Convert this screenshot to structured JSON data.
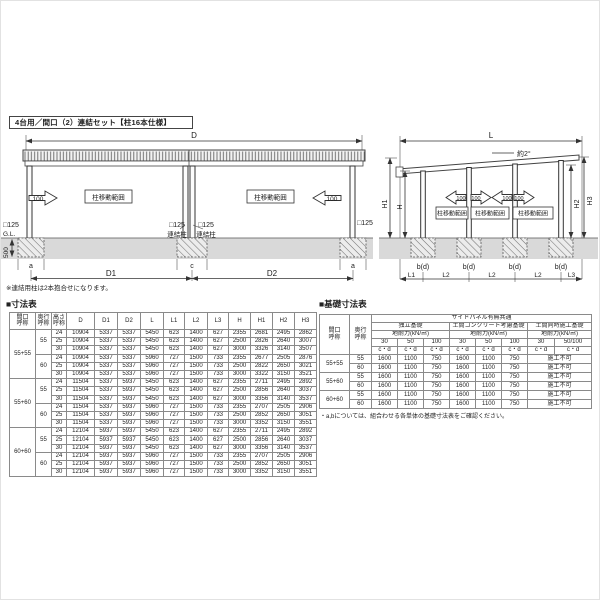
{
  "page": {
    "title": "4台用／間口（2）連結セット【柱16本仕様】"
  },
  "colors": {
    "ground": "#d9d9d9",
    "line": "#333333"
  },
  "front_view": {
    "dim_d": "D",
    "dim_d1": "D1",
    "dim_d2": "D2",
    "dim_a": "a",
    "dim_c": "c",
    "dim_500": "500",
    "gl": "G.L.",
    "sq125": "□125",
    "renketsu_pillar": "連結柱",
    "range_label": "柱移動範囲",
    "move_100": "100",
    "note": "※連結用柱は2本抱合せになります。"
  },
  "side_view": {
    "dim_l": "L",
    "slope": "約2°",
    "dim_h": "H",
    "dim_h1": "H1",
    "dim_h2": "H2",
    "dim_h3": "H3",
    "dim_l1": "L1",
    "dim_l2": "L2",
    "dim_l3": "L3",
    "bd": "b(d)",
    "range_label": "柱移動範囲",
    "move_100": "100"
  },
  "dim_table": {
    "title": "■寸法表",
    "headers": [
      "間口\n呼称",
      "奥行\n呼称",
      "高さ\n呼称",
      "D",
      "D1",
      "D2",
      "L",
      "L1",
      "L2",
      "L3",
      "H",
      "H1",
      "H2",
      "H3"
    ],
    "groups": [
      {
        "span": "55+55",
        "depths": [
          {
            "depth": "55",
            "rows": [
              [
                "24",
                "10904",
                "5337",
                "5337",
                "5450",
                "623",
                "1400",
                "627",
                "2355",
                "2681",
                "2495",
                "2862"
              ],
              [
                "25",
                "10904",
                "5337",
                "5337",
                "5450",
                "623",
                "1400",
                "627",
                "2500",
                "2826",
                "2640",
                "3007"
              ],
              [
                "30",
                "10904",
                "5337",
                "5337",
                "5450",
                "623",
                "1400",
                "627",
                "3000",
                "3326",
                "3140",
                "3507"
              ]
            ]
          },
          {
            "depth": "60",
            "rows": [
              [
                "24",
                "10904",
                "5337",
                "5337",
                "5960",
                "727",
                "1500",
                "733",
                "2355",
                "2677",
                "2505",
                "2876"
              ],
              [
                "25",
                "10904",
                "5337",
                "5337",
                "5960",
                "727",
                "1500",
                "733",
                "2500",
                "2822",
                "2650",
                "3021"
              ],
              [
                "30",
                "10904",
                "5337",
                "5337",
                "5960",
                "727",
                "1500",
                "733",
                "3000",
                "3322",
                "3150",
                "3521"
              ]
            ]
          }
        ]
      },
      {
        "span": "55+60",
        "depths": [
          {
            "depth": "55",
            "rows": [
              [
                "24",
                "11504",
                "5337",
                "5937",
                "5450",
                "623",
                "1400",
                "627",
                "2355",
                "2711",
                "2495",
                "2892"
              ],
              [
                "25",
                "11504",
                "5337",
                "5937",
                "5450",
                "623",
                "1400",
                "627",
                "2500",
                "2856",
                "2640",
                "3037"
              ],
              [
                "30",
                "11504",
                "5337",
                "5937",
                "5450",
                "623",
                "1400",
                "627",
                "3000",
                "3356",
                "3140",
                "3537"
              ]
            ]
          },
          {
            "depth": "60",
            "rows": [
              [
                "24",
                "11504",
                "5337",
                "5937",
                "5960",
                "727",
                "1500",
                "733",
                "2355",
                "2707",
                "2505",
                "2906"
              ],
              [
                "25",
                "11504",
                "5337",
                "5937",
                "5960",
                "727",
                "1500",
                "733",
                "2500",
                "2852",
                "2650",
                "3051"
              ],
              [
                "30",
                "11504",
                "5337",
                "5937",
                "5960",
                "727",
                "1500",
                "733",
                "3000",
                "3352",
                "3150",
                "3551"
              ]
            ]
          }
        ]
      },
      {
        "span": "60+60",
        "depths": [
          {
            "depth": "55",
            "rows": [
              [
                "24",
                "12104",
                "5937",
                "5937",
                "5450",
                "623",
                "1400",
                "627",
                "2355",
                "2711",
                "2495",
                "2892"
              ],
              [
                "25",
                "12104",
                "5937",
                "5937",
                "5450",
                "623",
                "1400",
                "627",
                "2500",
                "2856",
                "2640",
                "3037"
              ],
              [
                "30",
                "12104",
                "5937",
                "5937",
                "5450",
                "623",
                "1400",
                "627",
                "3000",
                "3356",
                "3140",
                "3537"
              ]
            ]
          },
          {
            "depth": "60",
            "rows": [
              [
                "24",
                "12104",
                "5937",
                "5937",
                "5960",
                "727",
                "1500",
                "733",
                "2355",
                "2707",
                "2505",
                "2906"
              ],
              [
                "25",
                "12104",
                "5937",
                "5937",
                "5960",
                "727",
                "1500",
                "733",
                "2500",
                "2852",
                "2650",
                "3051"
              ],
              [
                "30",
                "12104",
                "5937",
                "5937",
                "5960",
                "727",
                "1500",
                "733",
                "3000",
                "3352",
                "3150",
                "3551"
              ]
            ]
          }
        ]
      }
    ]
  },
  "foundation_table": {
    "title": "■基礎寸法表",
    "top_header": "サイドパネル有無共通",
    "col1": "間口\n呼称",
    "col2": "奥行\n呼称",
    "groups": [
      {
        "name": "独立基礎",
        "sub": "地耐力(kN/㎡)"
      },
      {
        "name": "土間コンクリート考慮基礎",
        "sub": "地耐力(kN/㎡)"
      },
      {
        "name": "土間同時施工基礎",
        "sub": "地耐力(kN/㎡)"
      }
    ],
    "strengths": [
      "30",
      "50",
      "100",
      "30",
      "50",
      "100",
      "30",
      "50/100"
    ],
    "unit": "c・d",
    "rows": [
      {
        "span": "55+55",
        "depth": "55",
        "values": [
          "1600",
          "1100",
          "750",
          "1600",
          "1100",
          "750"
        ],
        "na": "施工不可"
      },
      {
        "span": "55+55",
        "depth": "60",
        "values": [
          "1600",
          "1100",
          "750",
          "1600",
          "1100",
          "750"
        ],
        "na": "施工不可"
      },
      {
        "span": "55+60",
        "depth": "55",
        "values": [
          "1600",
          "1100",
          "750",
          "1600",
          "1100",
          "750"
        ],
        "na": "施工不可"
      },
      {
        "span": "55+60",
        "depth": "60",
        "values": [
          "1600",
          "1100",
          "750",
          "1600",
          "1100",
          "750"
        ],
        "na": "施工不可"
      },
      {
        "span": "60+60",
        "depth": "55",
        "values": [
          "1600",
          "1100",
          "750",
          "1600",
          "1100",
          "750"
        ],
        "na": "施工不可"
      },
      {
        "span": "60+60",
        "depth": "60",
        "values": [
          "1600",
          "1100",
          "750",
          "1600",
          "1100",
          "750"
        ],
        "na": "施工不可"
      }
    ],
    "note": "・a,bについては、組合わせる各単体の基礎寸法表をご確認ください。"
  }
}
